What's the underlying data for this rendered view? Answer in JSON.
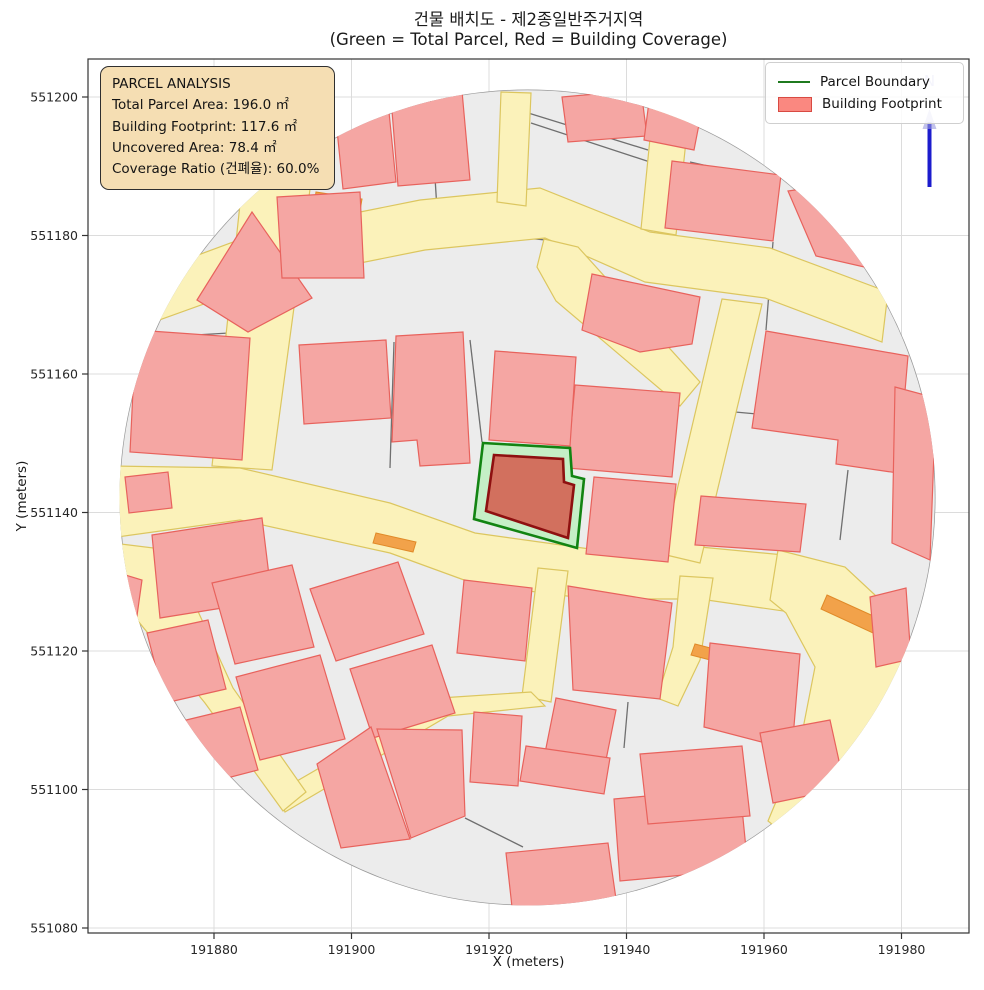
{
  "title": {
    "line1": "건물 배치도 - 제2종일반주거지역",
    "line2": "(Green = Total Parcel, Red = Building Coverage)"
  },
  "info_box": {
    "title": "PARCEL ANALYSIS",
    "lines": [
      "Total Parcel Area: 196.0 ㎡",
      "Building Footprint: 117.6 ㎡",
      "Uncovered Area: 78.4 ㎡",
      "Coverage Ratio (건폐율): 60.0%"
    ],
    "values": {
      "total_parcel_area_m2": 196.0,
      "building_footprint_m2": 117.6,
      "uncovered_area_m2": 78.4,
      "coverage_ratio_pct": 60.0
    }
  },
  "legend": {
    "items": [
      {
        "label": "Parcel Boundary",
        "type": "line",
        "color": "#1f7a1f"
      },
      {
        "label": "Building Footprint",
        "type": "patch",
        "fill": "#fa8880",
        "edge": "#d84a42"
      }
    ]
  },
  "axes": {
    "x_label": "X (meters)",
    "y_label": "Y (meters)",
    "left": 88,
    "right": 969,
    "top": 59,
    "bottom": 933,
    "x_ticks": [
      {
        "label": "191880",
        "px": 214
      },
      {
        "label": "191900",
        "px": 351.5
      },
      {
        "label": "191920",
        "px": 489
      },
      {
        "label": "191940",
        "px": 626.5
      },
      {
        "label": "191960",
        "px": 764
      },
      {
        "label": "191980",
        "px": 901.5
      }
    ],
    "y_ticks": [
      {
        "label": "551200",
        "px": 97
      },
      {
        "label": "551180",
        "px": 235.5
      },
      {
        "label": "551160",
        "px": 374
      },
      {
        "label": "551140",
        "px": 512.5
      },
      {
        "label": "551120",
        "px": 651
      },
      {
        "label": "551100",
        "px": 789.5
      },
      {
        "label": "551080",
        "px": 928
      }
    ]
  },
  "north": {
    "x": 929.5,
    "y1": 122,
    "y2": 187,
    "label": "N"
  },
  "colors": {
    "background": "#ffffff",
    "grid": "#dcdcdc",
    "spine": "#333333",
    "base": "#ececec",
    "base_edge": "#9a9a9a",
    "building_fill": "#f5a6a3",
    "building_edge": "#e8625c",
    "road_fill": "#fbf2ba",
    "road_edge": "#dcc65f",
    "orange": "#f2a24a",
    "orange_edge": "#e08a28",
    "parcel_line": "#6f6f6f",
    "parcel_green_fill": "#c5efc6",
    "parcel_green_edge": "#128412",
    "footprint_fill": "#d2705e",
    "footprint_edge": "#8e1010",
    "north_blue": "#1c1ccd",
    "info_bg": "#f5deb3"
  },
  "map": {
    "circle": {
      "cx": 527.5,
      "cy": 497.5,
      "r": 408
    },
    "parcel_boundary": [
      [
        483,
        443
      ],
      [
        570,
        448
      ],
      [
        572,
        476
      ],
      [
        584,
        479
      ],
      [
        577,
        548
      ],
      [
        474,
        519
      ]
    ],
    "building_footprint": [
      [
        494,
        455
      ],
      [
        563,
        459
      ],
      [
        564,
        482
      ],
      [
        574,
        485
      ],
      [
        568,
        538
      ],
      [
        486,
        511
      ]
    ],
    "roads": [
      [
        [
          112,
          287
        ],
        [
          260,
          232
        ],
        [
          420,
          200
        ],
        [
          540,
          188
        ],
        [
          650,
          232
        ],
        [
          770,
          248
        ],
        [
          888,
          292
        ],
        [
          882,
          342
        ],
        [
          765,
          298
        ],
        [
          645,
          282
        ],
        [
          545,
          238
        ],
        [
          425,
          250
        ],
        [
          265,
          282
        ],
        [
          112,
          337
        ]
      ],
      [
        [
          246,
          148
        ],
        [
          316,
          145
        ],
        [
          272,
          470
        ],
        [
          212,
          466
        ]
      ],
      [
        [
          110,
          466
        ],
        [
          240,
          468
        ],
        [
          390,
          503
        ],
        [
          475,
          533
        ],
        [
          590,
          549
        ],
        [
          700,
          547
        ],
        [
          795,
          556
        ],
        [
          790,
          612
        ],
        [
          700,
          599
        ],
        [
          590,
          599
        ],
        [
          475,
          584
        ],
        [
          390,
          553
        ],
        [
          240,
          520
        ],
        [
          110,
          538
        ]
      ],
      [
        [
          778,
          550
        ],
        [
          845,
          567
        ],
        [
          890,
          609
        ],
        [
          905,
          654
        ],
        [
          890,
          729
        ],
        [
          855,
          799
        ],
        [
          812,
          857
        ],
        [
          768,
          821
        ],
        [
          800,
          744
        ],
        [
          815,
          667
        ],
        [
          786,
          613
        ],
        [
          770,
          600
        ]
      ],
      [
        [
          655,
          88
        ],
        [
          691,
          94
        ],
        [
          676,
          235
        ],
        [
          641,
          229
        ]
      ],
      [
        [
          501,
          92
        ],
        [
          531,
          93
        ],
        [
          526,
          206
        ],
        [
          497,
          202
        ]
      ],
      [
        [
          722,
          299
        ],
        [
          762,
          304
        ],
        [
          700,
          563
        ],
        [
          662,
          554
        ]
      ],
      [
        [
          544,
          239
        ],
        [
          578,
          247
        ],
        [
          700,
          382
        ],
        [
          680,
          406
        ],
        [
          556,
          301
        ],
        [
          537,
          267
        ]
      ],
      [
        [
          538,
          568
        ],
        [
          568,
          571
        ],
        [
          551,
          702
        ],
        [
          522,
          696
        ]
      ],
      [
        [
          531,
          692
        ],
        [
          440,
          698
        ],
        [
          278,
          792
        ],
        [
          285,
          812
        ],
        [
          448,
          716
        ],
        [
          545,
          706
        ]
      ],
      [
        [
          113,
          543
        ],
        [
          170,
          550
        ],
        [
          233,
          688
        ],
        [
          306,
          792
        ],
        [
          283,
          811
        ],
        [
          205,
          703
        ],
        [
          107,
          583
        ]
      ],
      [
        [
          680,
          576
        ],
        [
          713,
          578
        ],
        [
          700,
          660
        ],
        [
          678,
          706
        ],
        [
          657,
          698
        ],
        [
          673,
          647
        ]
      ]
    ],
    "buildings": [
      [
        [
          197,
          300
        ],
        [
          252,
          212
        ],
        [
          312,
          298
        ],
        [
          248,
          332
        ]
      ],
      [
        [
          136,
          330
        ],
        [
          250,
          338
        ],
        [
          242,
          460
        ],
        [
          130,
          452
        ]
      ],
      [
        [
          277,
          197
        ],
        [
          360,
          192
        ],
        [
          364,
          278
        ],
        [
          282,
          278
        ]
      ],
      [
        [
          391,
          98
        ],
        [
          462,
          91
        ],
        [
          470,
          180
        ],
        [
          398,
          186
        ]
      ],
      [
        [
          336,
          120
        ],
        [
          389,
          112
        ],
        [
          396,
          182
        ],
        [
          343,
          189
        ]
      ],
      [
        [
          562,
          97
        ],
        [
          641,
          90
        ],
        [
          647,
          136
        ],
        [
          568,
          142
        ]
      ],
      [
        [
          650,
          94
        ],
        [
          702,
          109
        ],
        [
          694,
          150
        ],
        [
          644,
          140
        ]
      ],
      [
        [
          672,
          161
        ],
        [
          781,
          175
        ],
        [
          773,
          241
        ],
        [
          665,
          228
        ]
      ],
      [
        [
          788,
          191
        ],
        [
          866,
          180
        ],
        [
          908,
          277
        ],
        [
          816,
          256
        ]
      ],
      [
        [
          766,
          331
        ],
        [
          908,
          356
        ],
        [
          898,
          473
        ],
        [
          836,
          464
        ],
        [
          838,
          440
        ],
        [
          752,
          428
        ]
      ],
      [
        [
          592,
          274
        ],
        [
          700,
          297
        ],
        [
          692,
          344
        ],
        [
          640,
          352
        ],
        [
          582,
          330
        ]
      ],
      [
        [
          575,
          385
        ],
        [
          680,
          393
        ],
        [
          672,
          477
        ],
        [
          567,
          468
        ]
      ],
      [
        [
          396,
          336
        ],
        [
          463,
          332
        ],
        [
          470,
          463
        ],
        [
          420,
          466
        ],
        [
          417,
          440
        ],
        [
          392,
          442
        ]
      ],
      [
        [
          299,
          345
        ],
        [
          386,
          340
        ],
        [
          391,
          418
        ],
        [
          304,
          424
        ]
      ],
      [
        [
          125,
          477
        ],
        [
          168,
          472
        ],
        [
          172,
          508
        ],
        [
          129,
          513
        ]
      ],
      [
        [
          495,
          351
        ],
        [
          576,
          357
        ],
        [
          570,
          446
        ],
        [
          489,
          440
        ]
      ],
      [
        [
          594,
          477
        ],
        [
          676,
          484
        ],
        [
          668,
          562
        ],
        [
          586,
          554
        ]
      ],
      [
        [
          701,
          496
        ],
        [
          806,
          504
        ],
        [
          800,
          552
        ],
        [
          695,
          545
        ]
      ],
      [
        [
          152,
          535
        ],
        [
          262,
          518
        ],
        [
          272,
          600
        ],
        [
          160,
          618
        ]
      ],
      [
        [
          212,
          583
        ],
        [
          292,
          565
        ],
        [
          314,
          647
        ],
        [
          235,
          664
        ]
      ],
      [
        [
          147,
          633
        ],
        [
          208,
          620
        ],
        [
          226,
          689
        ],
        [
          165,
          703
        ]
      ],
      [
        [
          236,
          677
        ],
        [
          320,
          655
        ],
        [
          345,
          739
        ],
        [
          260,
          760
        ]
      ],
      [
        [
          178,
          722
        ],
        [
          240,
          707
        ],
        [
          258,
          770
        ],
        [
          196,
          786
        ]
      ],
      [
        [
          310,
          589
        ],
        [
          398,
          562
        ],
        [
          424,
          634
        ],
        [
          336,
          661
        ]
      ],
      [
        [
          350,
          669
        ],
        [
          432,
          645
        ],
        [
          455,
          713
        ],
        [
          373,
          738
        ]
      ],
      [
        [
          317,
          764
        ],
        [
          371,
          727
        ],
        [
          410,
          839
        ],
        [
          341,
          848
        ]
      ],
      [
        [
          377,
          729
        ],
        [
          462,
          730
        ],
        [
          465,
          816
        ],
        [
          411,
          838
        ]
      ],
      [
        [
          474,
          712
        ],
        [
          522,
          716
        ],
        [
          518,
          786
        ],
        [
          470,
          782
        ]
      ],
      [
        [
          464,
          580
        ],
        [
          532,
          588
        ],
        [
          525,
          661
        ],
        [
          457,
          653
        ]
      ],
      [
        [
          568,
          586
        ],
        [
          672,
          603
        ],
        [
          660,
          699
        ],
        [
          573,
          690
        ]
      ],
      [
        [
          556,
          698
        ],
        [
          616,
          710
        ],
        [
          604,
          770
        ],
        [
          544,
          758
        ]
      ],
      [
        [
          526,
          746
        ],
        [
          610,
          758
        ],
        [
          604,
          794
        ],
        [
          520,
          781
        ]
      ],
      [
        [
          614,
          799
        ],
        [
          658,
          795
        ],
        [
          660,
          779
        ],
        [
          700,
          777
        ],
        [
          702,
          791
        ],
        [
          740,
          788
        ],
        [
          748,
          869
        ],
        [
          620,
          881
        ]
      ],
      [
        [
          506,
          853
        ],
        [
          608,
          843
        ],
        [
          617,
          906
        ],
        [
          513,
          916
        ]
      ],
      [
        [
          710,
          643
        ],
        [
          800,
          654
        ],
        [
          792,
          750
        ],
        [
          704,
          727
        ]
      ],
      [
        [
          640,
          754
        ],
        [
          742,
          746
        ],
        [
          750,
          816
        ],
        [
          648,
          824
        ]
      ],
      [
        [
          760,
          733
        ],
        [
          830,
          720
        ],
        [
          845,
          788
        ],
        [
          773,
          803
        ]
      ],
      [
        [
          870,
          597
        ],
        [
          906,
          588
        ],
        [
          911,
          659
        ],
        [
          876,
          667
        ]
      ],
      [
        [
          895,
          387
        ],
        [
          936,
          398
        ],
        [
          930,
          560
        ],
        [
          892,
          543
        ]
      ],
      [
        [
          109,
          570
        ],
        [
          142,
          580
        ],
        [
          135,
          630
        ],
        [
          105,
          618
        ]
      ]
    ],
    "orange_accents": [
      [
        [
          316,
          192
        ],
        [
          362,
          199
        ],
        [
          360,
          211
        ],
        [
          314,
          204
        ]
      ],
      [
        [
          376,
          533
        ],
        [
          416,
          542
        ],
        [
          413,
          552
        ],
        [
          373,
          543
        ]
      ],
      [
        [
          827,
          595
        ],
        [
          880,
          619
        ],
        [
          873,
          633
        ],
        [
          821,
          609
        ]
      ],
      [
        [
          695,
          644
        ],
        [
          722,
          651
        ],
        [
          718,
          662
        ],
        [
          691,
          655
        ]
      ]
    ],
    "parcel_lines": [
      [
        [
          430,
          96
        ],
        [
          438,
          226
        ]
      ],
      [
        [
          438,
          226
        ],
        [
          525,
          238
        ],
        [
          648,
          250
        ]
      ],
      [
        [
          525,
          107
        ],
        [
          520,
          238
        ]
      ],
      [
        [
          525,
          112
        ],
        [
          648,
          150
        ]
      ],
      [
        [
          531,
          123
        ],
        [
          650,
          162
        ]
      ],
      [
        [
          690,
          162
        ],
        [
          770,
          180
        ]
      ],
      [
        [
          252,
          212
        ],
        [
          300,
          300
        ]
      ],
      [
        [
          178,
          336
        ],
        [
          246,
          332
        ]
      ],
      [
        [
          394,
          342
        ],
        [
          390,
          468
        ]
      ],
      [
        [
          470,
          340
        ],
        [
          482,
          442
        ]
      ],
      [
        [
          713,
          410
        ],
        [
          757,
          414
        ]
      ],
      [
        [
          773,
          242
        ],
        [
          766,
          330
        ]
      ],
      [
        [
          845,
          190
        ],
        [
          890,
          268
        ]
      ],
      [
        [
          465,
          818
        ],
        [
          523,
          847
        ]
      ],
      [
        [
          628,
          702
        ],
        [
          624,
          748
        ]
      ],
      [
        [
          160,
          616
        ],
        [
          148,
          634
        ]
      ],
      [
        [
          848,
          470
        ],
        [
          840,
          540
        ]
      ]
    ]
  }
}
